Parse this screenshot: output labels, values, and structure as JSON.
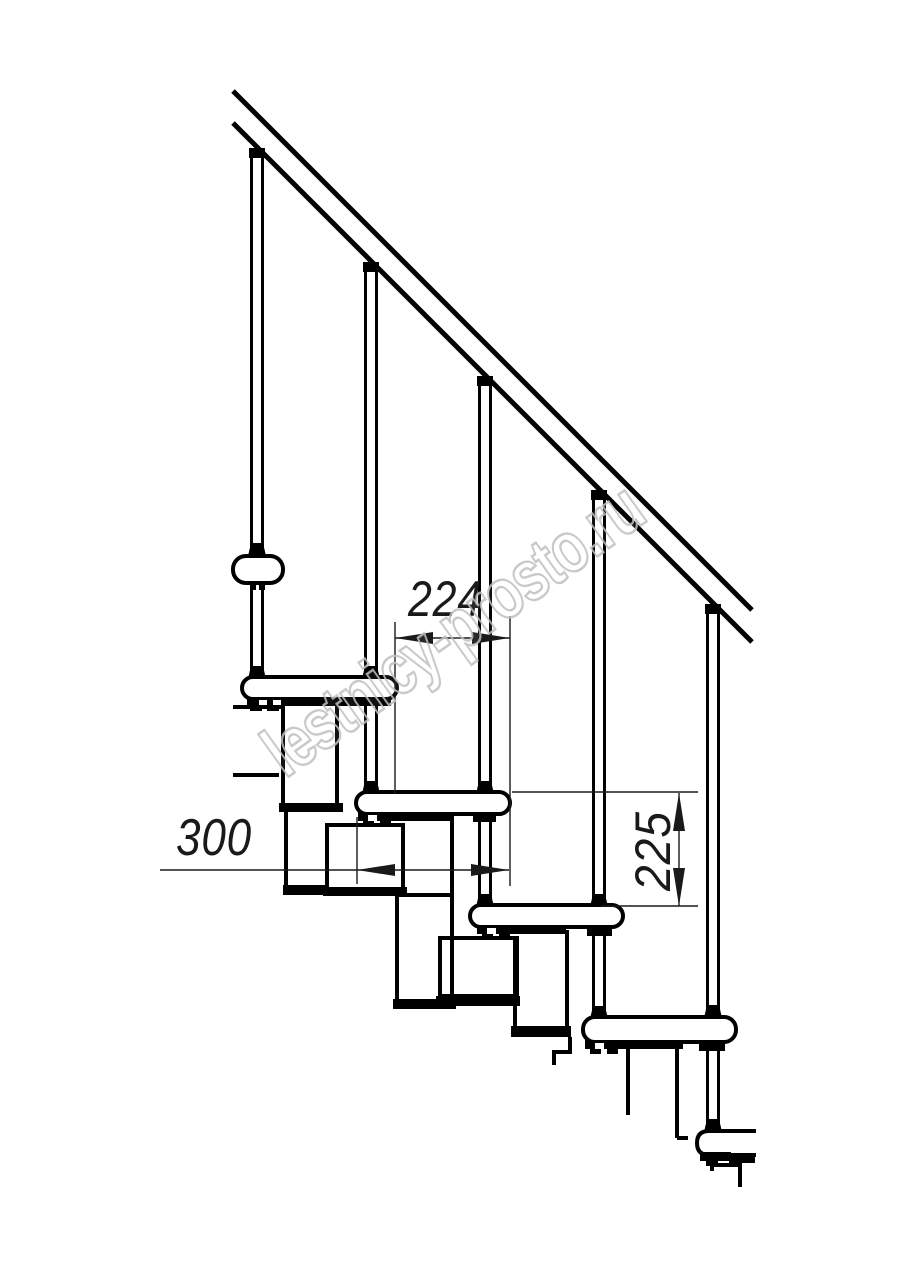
{
  "colors": {
    "background": "#ffffff",
    "line": "#000000",
    "dimension": "#1a1a1a",
    "watermark": "#c0c0c0"
  },
  "dimensions": {
    "step_run": "224",
    "tread_depth": "300",
    "riser_height": "225"
  },
  "watermark": {
    "text": "lestnicy-prosto.ru"
  }
}
